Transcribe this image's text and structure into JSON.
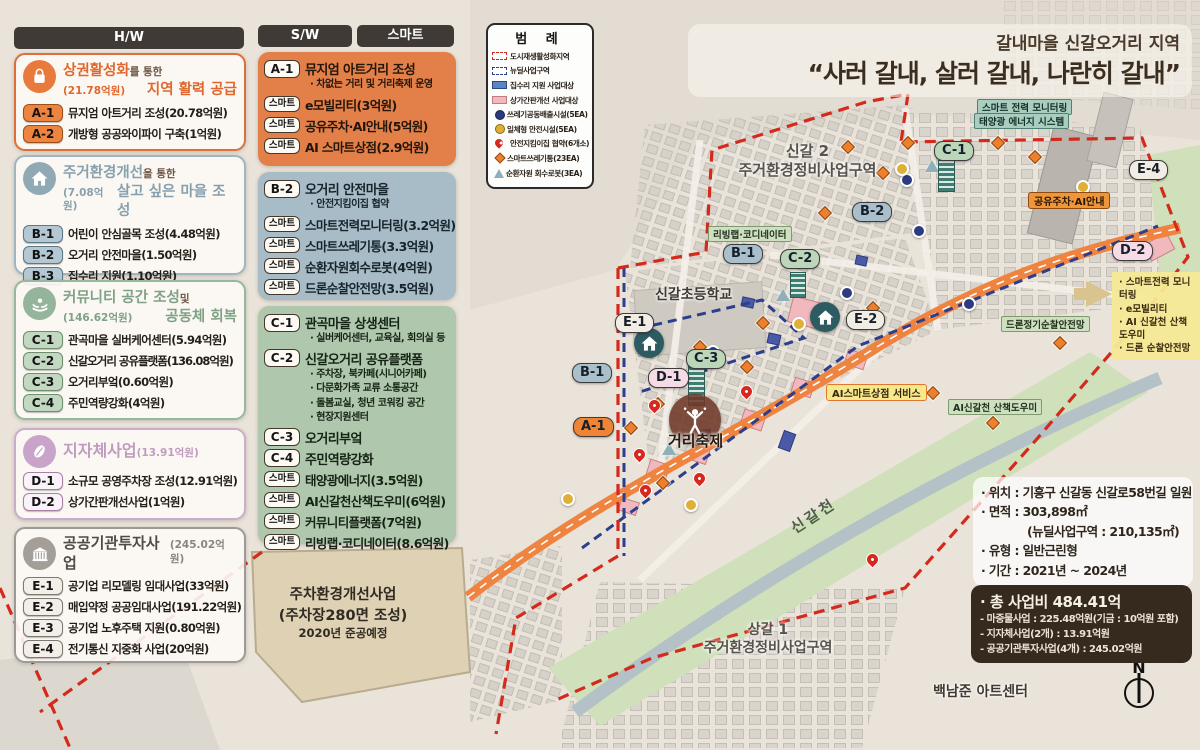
{
  "title": {
    "region": "갈내마을 신갈오거리 지역",
    "slogan": "“사러 갈내, 살러 갈내, 나란히 갈내”"
  },
  "columns": {
    "hw": "H/W",
    "sw": "S/W",
    "smart": "스마트"
  },
  "hw": {
    "boxes": [
      {
        "icon": "shopping-bag-icon",
        "title_main": "상권활성화",
        "title_suffix": "를 통한",
        "budget": "(21.78억원)",
        "subtitle": "지역 활력 공급",
        "items": [
          {
            "badge": "A-1",
            "label": "뮤지엄 아트거리 조성(20.78억원)"
          },
          {
            "badge": "A-2",
            "label": "개방형 공공와이파이 구축(1억원)"
          }
        ]
      },
      {
        "icon": "house-icon",
        "title_main": "주거환경개선",
        "title_suffix": "을 통한",
        "budget": "(7.08억원)",
        "subtitle": "살고 싶은 마을 조성",
        "items": [
          {
            "badge": "B-1",
            "label": "어린이 안심골목 조성(4.48억원)"
          },
          {
            "badge": "B-2",
            "label": "오거리 안전마을(1.50억원)"
          },
          {
            "badge": "B-3",
            "label": "집수리 지원(1.10억원)"
          }
        ]
      },
      {
        "icon": "community-hands-icon",
        "title_main": "커뮤니티 공간 조성",
        "title_suffix": "및",
        "budget": "(146.62억원)",
        "subtitle": "공동체 회복",
        "items": [
          {
            "badge": "C-1",
            "label": "관곡마을 실버케어센터(5.94억원)"
          },
          {
            "badge": "C-2",
            "label": "신갈오거리 공유플랫폼(136.08억원)"
          },
          {
            "badge": "C-3",
            "label": "오거리부엌(0.60억원)"
          },
          {
            "badge": "C-4",
            "label": "주민역량강화(4억원)"
          }
        ]
      },
      {
        "icon": "bean-icon",
        "title_main": "지자체사업",
        "budget": "(13.91억원)",
        "items": [
          {
            "badge": "D-1",
            "label": "소규모 공영주차장 조성(12.91억원)"
          },
          {
            "badge": "D-2",
            "label": "상가간판개선사업(1억원)"
          }
        ]
      },
      {
        "icon": "public-building-icon",
        "title_main": "공공기관투자사업",
        "budget": "(245.02억원)",
        "items": [
          {
            "badge": "E-1",
            "label": "공기업 리모델링 임대사업(33억원)"
          },
          {
            "badge": "E-2",
            "label": "매입약정 공공임대사업(191.22억원)"
          },
          {
            "badge": "E-3",
            "label": "공기업 노후주택 지원(0.80억원)"
          },
          {
            "badge": "E-4",
            "label": "전기통신 지중화 사업(20억원)"
          }
        ]
      }
    ]
  },
  "sw": {
    "boxes": [
      {
        "rows": [
          {
            "badge": "A-1",
            "label": "뮤지엄 아트거리 조성",
            "subs": [
              "· 차없는 거리 및 거리축제 운영"
            ]
          },
          {
            "badge": "스마트",
            "label": "e모빌리티(3억원)"
          },
          {
            "badge": "스마트",
            "label": "공유주차·AI안내(5억원)"
          },
          {
            "badge": "스마트",
            "label": "AI 스마트상점(2.9억원)"
          }
        ]
      },
      {
        "rows": [
          {
            "badge": "B-2",
            "label": "오거리 안전마을",
            "subs": [
              "· 안전지킴이집 협약"
            ]
          },
          {
            "badge": "스마트",
            "label": "스마트전력모니터링(3.2억원)"
          },
          {
            "badge": "스마트",
            "label": "스마트쓰레기통(3.3억원)"
          },
          {
            "badge": "스마트",
            "label": "순환자원회수로봇(4억원)"
          },
          {
            "badge": "스마트",
            "label": "드론순찰안전망(3.5억원)"
          }
        ]
      },
      {
        "rows": [
          {
            "badge": "C-1",
            "label": "관곡마을 상생센터",
            "subs": [
              "· 실버케어센터, 교육실, 회의실 등"
            ]
          },
          {
            "badge": "C-2",
            "label": "신갈오거리 공유플랫폼",
            "subs": [
              "· 주차장, 북카페(시니어카페)",
              "· 다문화가족 교류 소통공간",
              "· 돌봄교실, 청년 코워킹 공간",
              "· 현장지원센터"
            ]
          },
          {
            "badge": "C-3",
            "label": "오거리부엌"
          },
          {
            "badge": "C-4",
            "label": "주민역량강화"
          },
          {
            "badge": "스마트",
            "label": "태양광에너지(3.5억원)"
          },
          {
            "badge": "스마트",
            "label": "AI신갈천산책도우미(6억원)"
          },
          {
            "badge": "스마트",
            "label": "커뮤니티플랫폼(7억원)"
          },
          {
            "badge": "스마트",
            "label": "리빙랩·코디네이터(8.6억원)"
          }
        ]
      }
    ]
  },
  "legend": {
    "title": "범 례",
    "items": [
      {
        "symbol": "red-dashed-area",
        "label": "도시재생활성화지역"
      },
      {
        "symbol": "blue-dashed-area",
        "label": "뉴딜사업구역"
      },
      {
        "symbol": "blue-rect",
        "label": "집수리 지원 사업대상"
      },
      {
        "symbol": "pink-rect",
        "label": "상가간판개선 사업대상"
      },
      {
        "symbol": "navy-circle",
        "label": "쓰레기공동배출시설(5EA)"
      },
      {
        "symbol": "yellow-circle",
        "label": "일체형 안전시설(5EA)"
      },
      {
        "symbol": "red-pin",
        "label": "안전지킴이집 협약(6개소)"
      },
      {
        "symbol": "orange-diamond",
        "label": "스마트쓰레기통(23EA)"
      },
      {
        "symbol": "teal-triangle",
        "label": "순환자원 회수로봇(3EA)"
      }
    ]
  },
  "map": {
    "badges": [
      "E-1",
      "C-3",
      "D-1",
      "B-1",
      "A-1",
      "B-1",
      "C-2",
      "B-2",
      "C-1",
      "E-2",
      "E-4",
      "D-2"
    ],
    "labels": {
      "school": "신갈초등학교",
      "singal2_line1": "신갈 2",
      "singal2_line2": "주거환경정비사업구역",
      "sanggal1_line1": "상갈 1",
      "sanggal1_line2": "주거환경정비사업구역",
      "festival": "거리축제",
      "ai_store": "AI스마트상점 서비스",
      "shared_parking": "공유주차·AI안내",
      "smart_power": "스마트 전력 모니터링",
      "solar_system": "태양광 에너지 시스템",
      "living_lab": "리빙랩·코디네이터",
      "drone": "드론정기순찰안전망",
      "ai_walk": "AI신갈천 산책도우미",
      "river": "신갈천",
      "art_center": "백남준 아트센터",
      "compass": "N",
      "parking_line1": "주차환경개선사업",
      "parking_line2": "(주차장280면 조성)",
      "parking_line3": "2020년 준공예정",
      "smart_list": [
        "· 스마트전력 모니터링",
        "· e모빌리티",
        "· AI 신갈천 산책도우미",
        "· 드론 순찰안전망"
      ]
    }
  },
  "info": {
    "lines": [
      "· 위치 : 기흥구 신갈동 신갈로58번길 일원",
      "· 면적 : 303,898㎡",
      "(뉴딜사업구역 : 210,135㎡)",
      "· 유형 : 일반근린형",
      "· 기간 : 2021년 ~ 2024년"
    ]
  },
  "budget_box": {
    "title": "· 총 사업비 484.41억",
    "lines": [
      "- 마중물사업 : 225.48억원(기금 : 10억원 포함)",
      "- 지자체사업(2개) : 13.91억원",
      "- 공공기관투자사업(4개) : 245.02억원"
    ]
  },
  "icons": {
    "hw_a": "shopping-bag-icon",
    "hw_b": "house-icon",
    "hw_c": "community-hands-icon",
    "hw_d": "bean-icon",
    "hw_e": "public-building-icon",
    "map_house": "house-icon",
    "festival": "dancing-person-icon",
    "compass": "north-compass-icon"
  },
  "colors": {
    "hw_a": "#e0672e",
    "hw_b": "#87a0ad",
    "hw_c": "#7fa186",
    "hw_d": "#bf9cbf",
    "hw_e": "#4f4a44",
    "sw_a_bg": "#e37f48",
    "sw_b_bg": "#a7bcc6",
    "sw_c_bg": "#afc7ac",
    "boundary_red": "#d32a1c",
    "boundary_blue": "#2c3e8c",
    "road_orange": "#ef8340",
    "river_green": "#cfe0ba",
    "dark_box": "#362a1f"
  }
}
